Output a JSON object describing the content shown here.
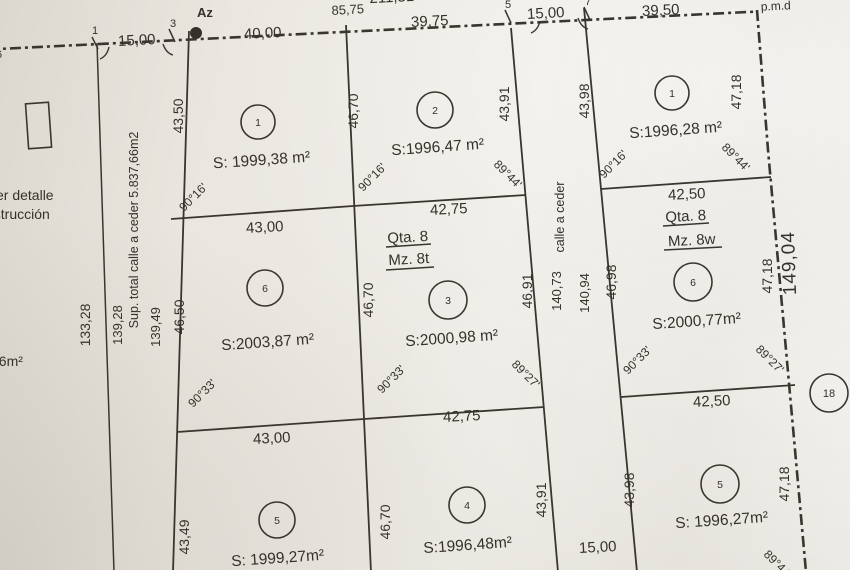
{
  "boundary": {
    "top_cut_measure": "211,31",
    "above_measure": "85,75",
    "azimuth_label": "Az",
    "pmd_label": "p.m.d",
    "right_total": "149,04",
    "vertices": {
      "v6": "6",
      "v1": "1",
      "v3": "3",
      "v5": "5",
      "v7": "7",
      "v18": "18"
    },
    "top_measures": {
      "m1": "15,00",
      "m2": "40,00",
      "m3": "39,75",
      "m4": "15,00",
      "m5": "39,50"
    }
  },
  "left_margin": {
    "note_line1": "er detalle",
    "note_line2": "nstrucción",
    "partial_area": "96m²",
    "measure": "133,28"
  },
  "street_left": {
    "name": "Sup. total calle a ceder 5.837,66m2",
    "measure_a": "139,28",
    "measure_b": "139,49"
  },
  "street_right": {
    "name": "calle a ceder",
    "measure_a": "140,73",
    "measure_b": "140,94",
    "width_bottom": "15,00"
  },
  "blocks": {
    "mz8t": {
      "qta": "Qta. 8",
      "mz": "Mz. 8t"
    },
    "mz8w": {
      "qta": "Qta. 8",
      "mz": "Mz. 8w"
    }
  },
  "dividers": {
    "h1a": "43,00",
    "h1b": "42,75",
    "h1c": "42,50",
    "h2a": "43,00",
    "h2b": "42,75",
    "h2c": "42,50"
  },
  "sides": {
    "r1": [
      "43,50",
      "46,70",
      "43,91",
      "43,98",
      "47,18"
    ],
    "r2": [
      "46,50",
      "46,70",
      "46,91",
      "46,98",
      "47,18"
    ],
    "r3": [
      "43,49",
      "46,70",
      "43,91",
      "43,98",
      "47,18"
    ]
  },
  "parcels": {
    "t1": {
      "num": "1",
      "area": "S: 1999,38 m²",
      "angle_bl": "90°16'"
    },
    "t2": {
      "num": "2",
      "area": "S:1996,47 m²",
      "angle_bl": "90°16'",
      "angle_br": "89°44'"
    },
    "t6": {
      "num": "6",
      "area": "S:2003,87 m²",
      "angle_bl": "90°33'"
    },
    "t3": {
      "num": "3",
      "area": "S:2000,98 m²",
      "angle_bl": "90°33'",
      "angle_br": "89°27'"
    },
    "t5": {
      "num": "5",
      "area": "S: 1999,27m²"
    },
    "t4": {
      "num": "4",
      "area": "S:1996,48m²"
    },
    "w1": {
      "num": "1",
      "area": "S:1996,28 m²",
      "angle_bl": "90°16'",
      "angle_br": "89°44'"
    },
    "w6": {
      "num": "6",
      "area": "S:2000,77m²",
      "angle_bl": "90°33'",
      "angle_br": "89°27'"
    },
    "w5": {
      "num": "5",
      "area": "S: 1996,27m²",
      "angle_br": "89°44'"
    }
  }
}
